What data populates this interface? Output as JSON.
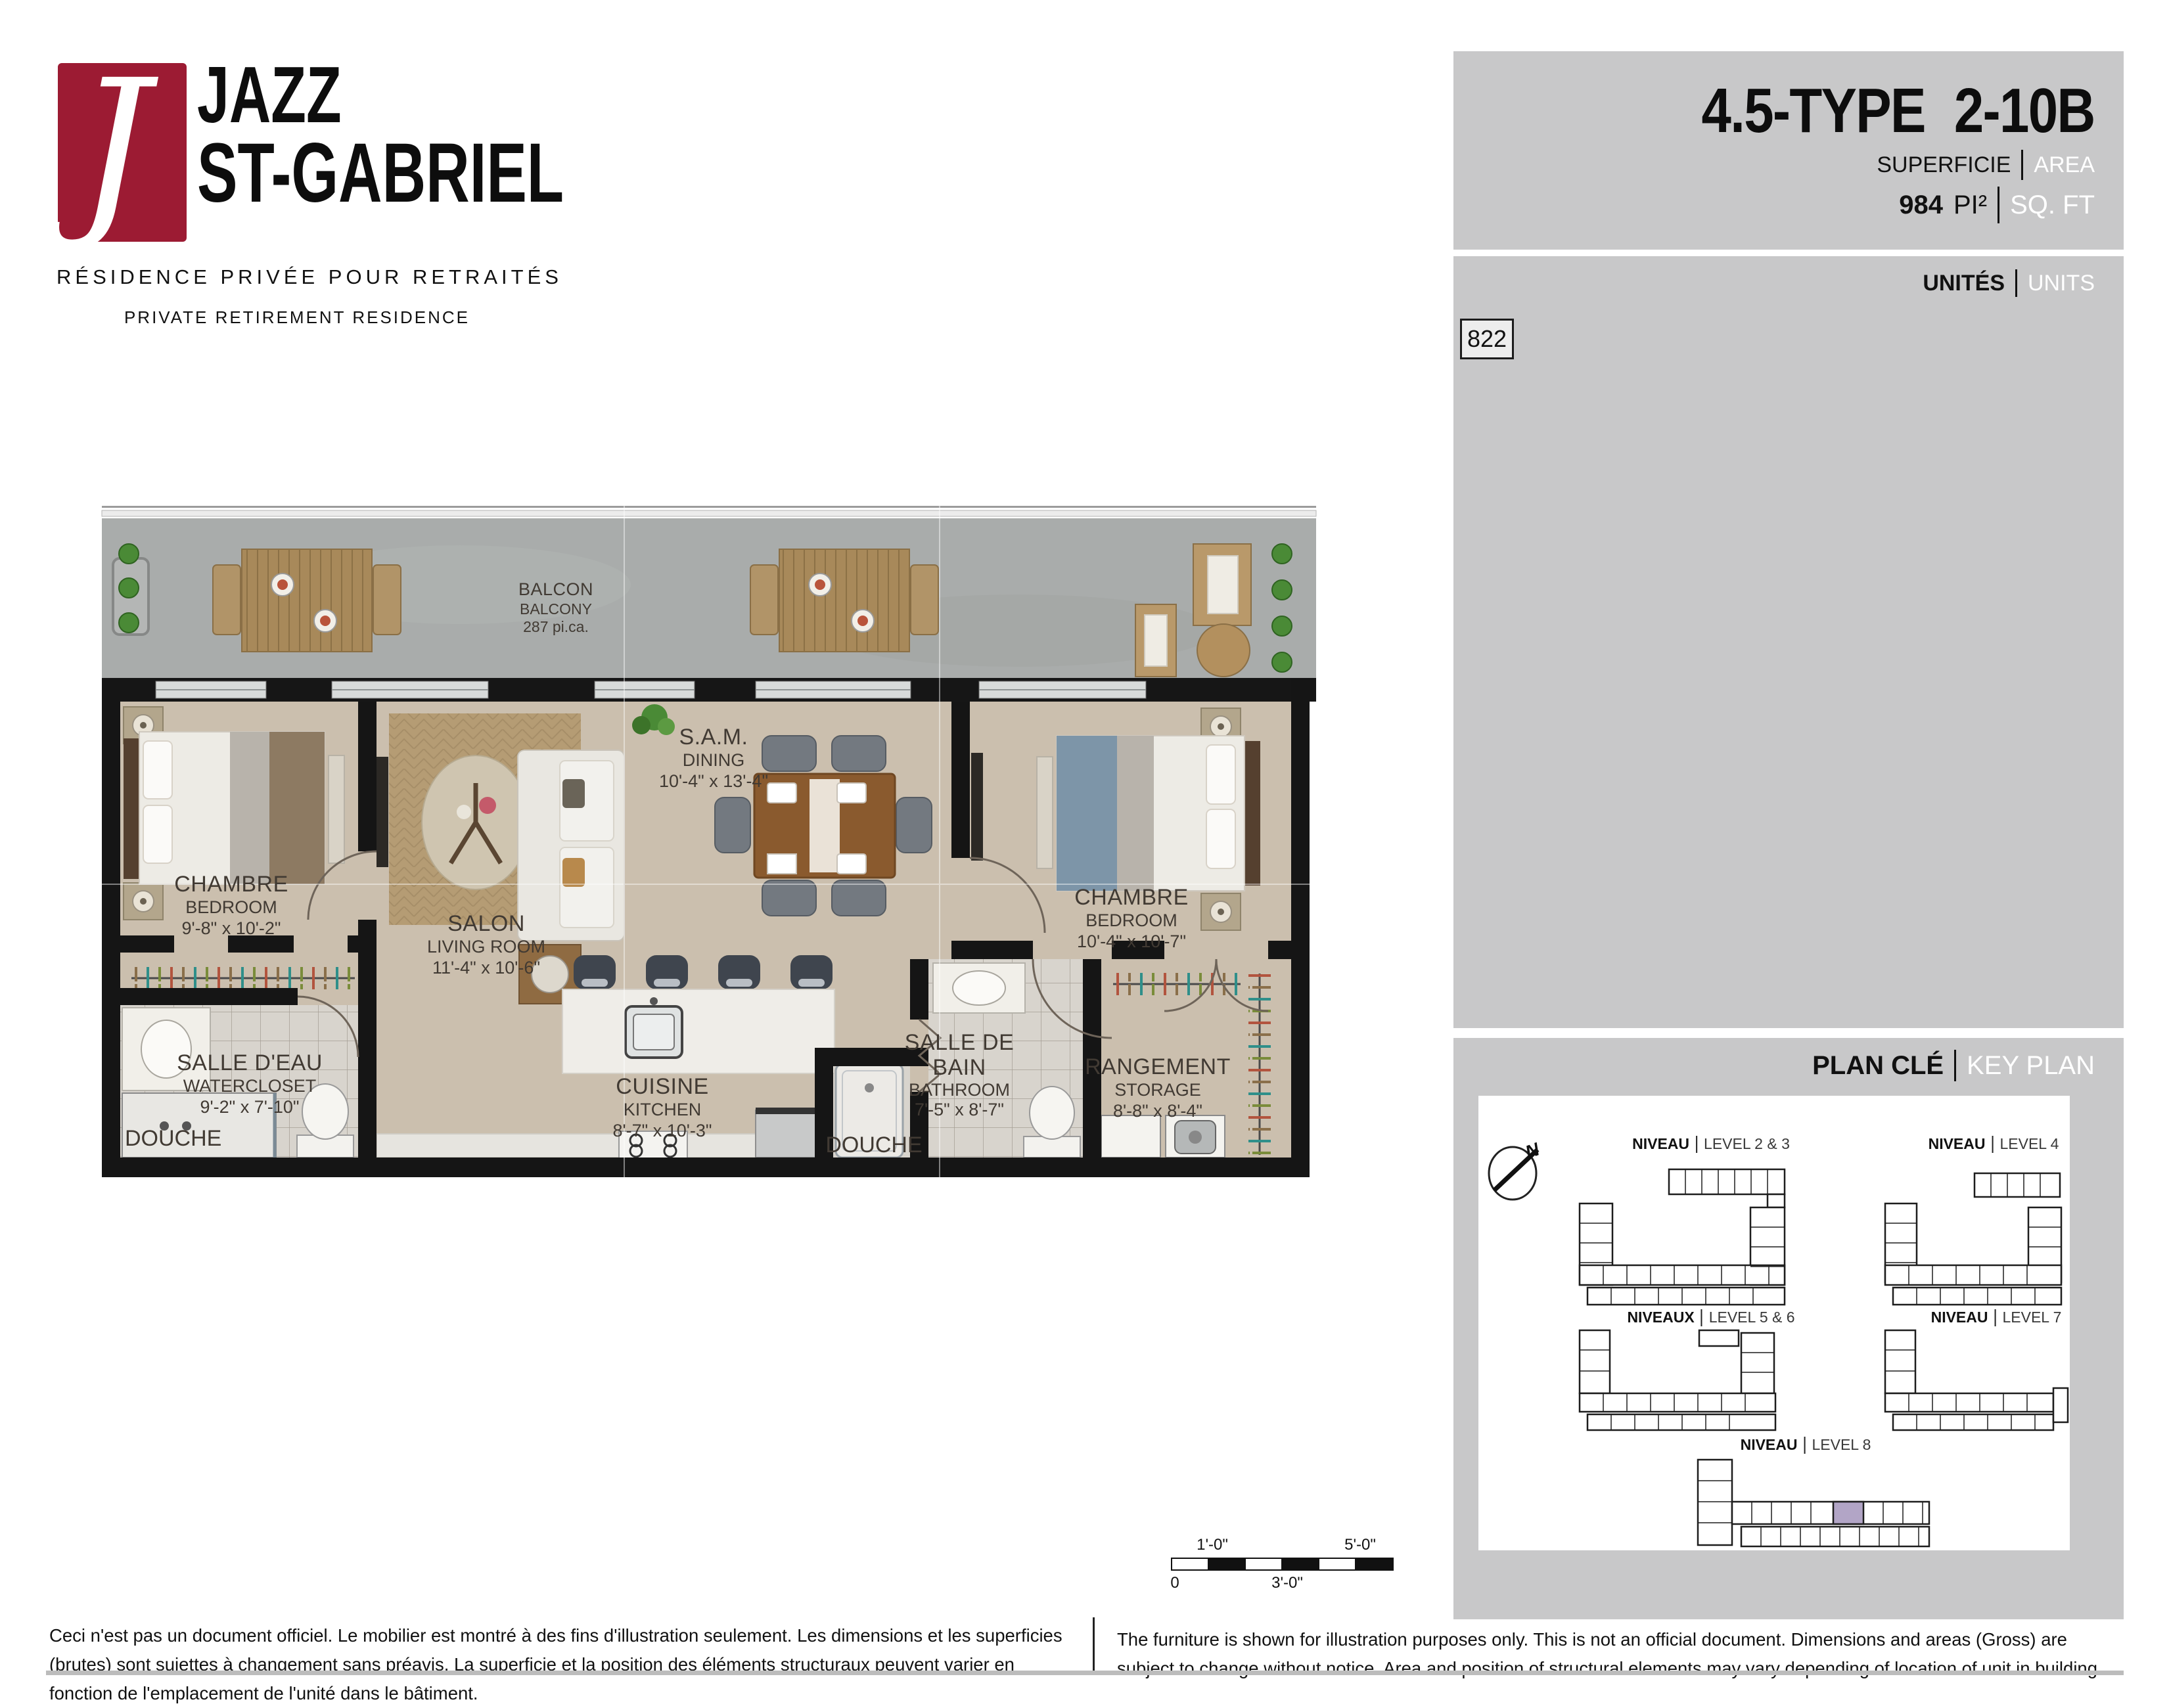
{
  "logo": {
    "mark": "J",
    "mark_color": "#9c1b33",
    "brand_line1": "JAZZ",
    "brand_line2": "ST-GABRIEL",
    "tagline_fr": "RÉSIDENCE PRIVÉE POUR RETRAITÉS",
    "tagline_en": "PRIVATE RETIREMENT RESIDENCE"
  },
  "header": {
    "unit_type": "4.5-TYPE",
    "unit_code": "2-10B",
    "area_label_fr": "SUPERFICIE",
    "area_label_en": "AREA",
    "area_value": "984",
    "area_unit_fr": "PI²",
    "area_unit_en": "SQ. FT"
  },
  "units_panel": {
    "label_fr": "UNITÉS",
    "label_en": "UNITS",
    "unit_number": "822"
  },
  "floor_plan": {
    "balcony": {
      "name_fr": "BALCON",
      "name_en": "BALCONY",
      "area": "287 pi.ca."
    },
    "shower_label": "DOUCHE",
    "rooms": [
      {
        "name_fr": "CHAMBRE",
        "name_en": "BEDROOM",
        "dims": "9'-8\" x 10'-2\""
      },
      {
        "name_fr": "SALON",
        "name_en": "LIVING ROOM",
        "dims": "11'-4\" x 10'-6\""
      },
      {
        "name_fr": "S.A.M.",
        "name_en": "DINING",
        "dims": "10'-4\" x 13'-4\""
      },
      {
        "name_fr": "CHAMBRE",
        "name_en": "BEDROOM",
        "dims": "10'-4\" x 10'-7\""
      },
      {
        "name_fr": "SALLE D'EAU",
        "name_en": "WATERCLOSET",
        "dims": "9'-2\" x 7'-10\""
      },
      {
        "name_fr": "CUISINE",
        "name_en": "KITCHEN",
        "dims": "8'-7\" x 10'-3\""
      },
      {
        "name_fr": "SALLE DE BAIN",
        "name_en": "BATHROOM",
        "dims": "7'-5\" x 8'-7\""
      },
      {
        "name_fr": "RANGEMENT",
        "name_en": "STORAGE",
        "dims": "8'-8\" x 8'-4\""
      }
    ]
  },
  "key_plan": {
    "title_fr": "PLAN CLÉ",
    "title_en": "KEY PLAN",
    "north_label": "N",
    "highlight_color": "#b2a5c6",
    "levels": [
      {
        "label_fr": "NIVEAU",
        "label_en": "LEVEL 2 & 3"
      },
      {
        "label_fr": "NIVEAU",
        "label_en": "LEVEL 4"
      },
      {
        "label_fr": "NIVEAUX",
        "label_en": "LEVEL 5 & 6"
      },
      {
        "label_fr": "NIVEAU",
        "label_en": "LEVEL 7"
      },
      {
        "label_fr": "NIVEAU",
        "label_en": "LEVEL 8"
      }
    ]
  },
  "scale_bar": {
    "top_left": "1'-0\"",
    "top_right": "5'-0\"",
    "bottom_left": "0",
    "bottom_center": "3'-0\""
  },
  "disclaimers": {
    "fr": "Ceci n'est pas un document officiel.  Le mobilier est montré à des fins d'illustration seulement.  Les dimensions et les superficies (brutes) sont sujettes à changement sans préavis. La superficie et la position des éléments structuraux peuvent varier en fonction de l'emplacement de l'unité dans le bâtiment.",
    "en": "The furniture is shown for illustration purposes only.  This is not an official document.  Dimensions and areas (Gross) are subject to change without notice.  Area and position of structural elements may vary depending of location of unit in building."
  }
}
